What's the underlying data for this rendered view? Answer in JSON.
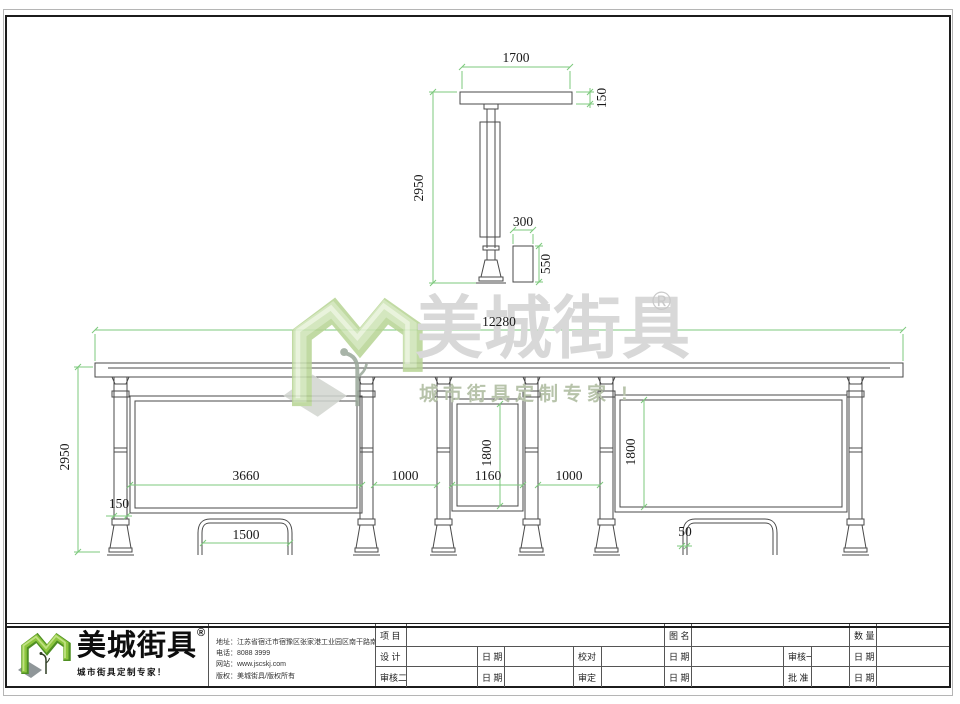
{
  "watermark": {
    "brand": "美城街具",
    "reg": "®",
    "tagline": "城市街具定制专家 !"
  },
  "side_view": {
    "roof_width": "1700",
    "roof_thickness": "150",
    "height": "2950",
    "bin_width": "300",
    "bin_height": "550"
  },
  "front_view": {
    "total_width": "12280",
    "height": "2950",
    "left_panel_width": "3660",
    "gap_left": "1000",
    "middle_panel_width": "1160",
    "gap_right": "1000",
    "middle_panel_height": "1800",
    "right_panel_height": "1800",
    "post_width": "150",
    "bench_width": "1500",
    "bench_leg_width": "50"
  },
  "footer": {
    "logo": {
      "brand": "美城街具",
      "reg": "®",
      "tagline": "城市街具定制专家！"
    },
    "contact": {
      "address": "地址：江苏省宿迁市宿豫区张家港工业园区南干路南侧1号",
      "phone": "电话：8088 3999",
      "website": "网站：www.jscskj.com",
      "copyright": "版权：美城街具/版权所有"
    },
    "titleblock": {
      "r1c1": "项 目",
      "r1c2": "图 名",
      "r1c3": "数 量",
      "r2c1": "设 计",
      "r2c2": "日 期",
      "r2c3": "校对",
      "r2c4": "日 期",
      "r2c5": "审核一",
      "r2c6": "日 期",
      "r3c1": "审核二",
      "r3c2": "日 期",
      "r3c3": "审定",
      "r3c4": "日 期",
      "r3c5": "批 准",
      "r3c6": "日 期"
    }
  },
  "colors": {
    "dimension_green": "#7cc97c",
    "line_gray": "#4a4a4a",
    "brand_green": "#8dc63f"
  }
}
